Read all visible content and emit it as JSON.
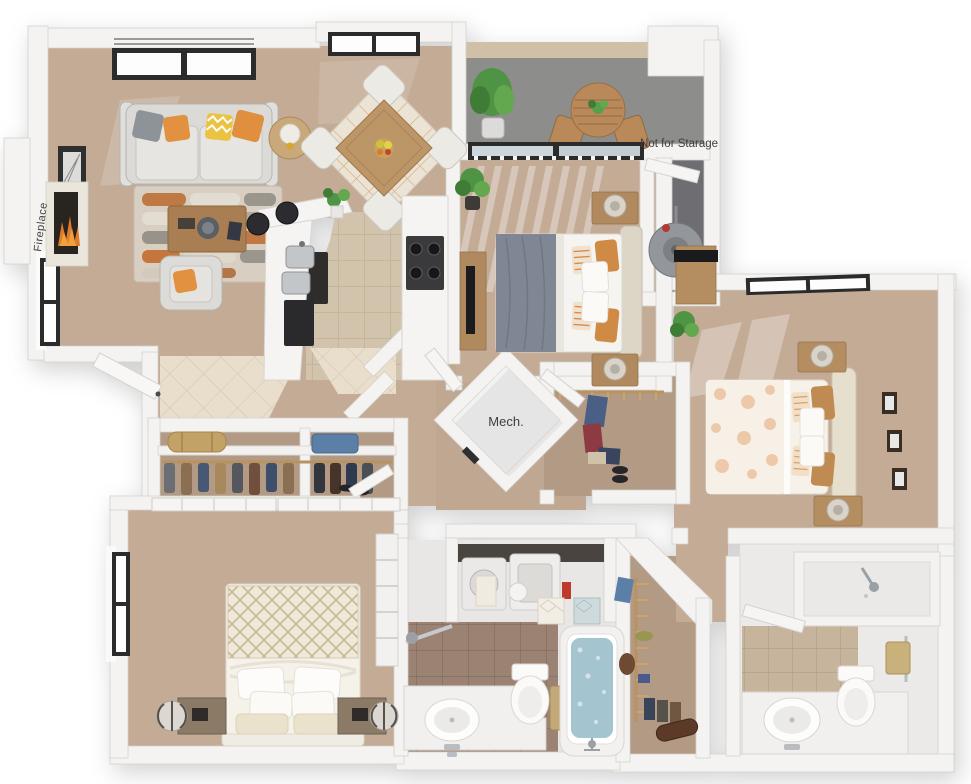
{
  "plan": {
    "labels": {
      "fireplace": "Fireplace",
      "balcony_note": "Not for Starage",
      "mech_room": "Mech."
    },
    "palette": {
      "background": "#ffffff",
      "wall": "#f4f3f1",
      "wall_shadow": "#d3d1cd",
      "carpet": "#c3ab96",
      "closet_carpet": "#b29a85",
      "kitchen_tile": "#d2c4ac",
      "bath_tile_brown": "#9b8273",
      "bath_tile_tan": "#c6b59c",
      "entry_tile": "#e8decb",
      "balcony_concrete": "#8d8d8b",
      "utility_floor": "#6e6d71",
      "tub_water": "#a4c4cf",
      "accent_orange": "#cf8a45",
      "wood_furniture": "#b08a5e",
      "sofa_gray": "#dbdad6",
      "duvet_gray": "#7e8793",
      "fire_flame": "#e07a2c",
      "plant_green": "#4f9444",
      "appliance_black": "#2c2c2e",
      "window_frame": "#2b2b2b"
    }
  }
}
